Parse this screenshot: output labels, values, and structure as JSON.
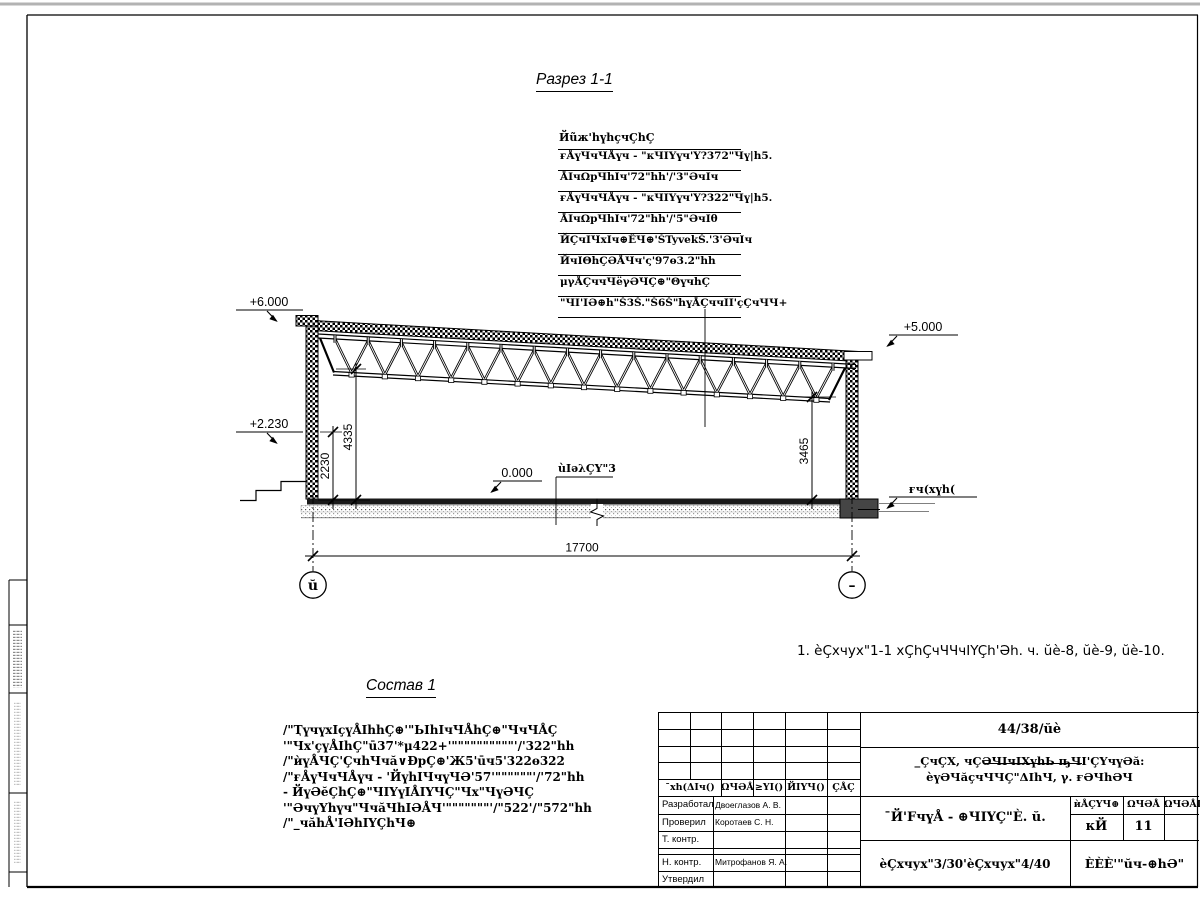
{
  "drawing": {
    "section_title": "Разрез 1-1",
    "roof_callout": {
      "header": "Йũж'hүhçчÇhÇ",
      "rows": [
        "ғÅүЧчЧÅүч - \"кЧIYүч'Y?372\"Чү|h5.",
        "ÅIчΩрЧhIч'72\"hh'/'3\"ӘчIч",
        "ғÅүЧчЧÅүч - \"кЧIYүч'Y?322\"Чү|h5.",
        "ÅIчΩрЧhIч'72\"hh'/'5\"ӘчIθ",
        "ЙÇчIЧхIч⊕ÊЧ⊕'ŠTyvekŠ.'3'ӘчIч",
        "ЙчIΘhÇӘÅЧч'ς'97ө3.2\"hh",
        "μγÅÇччЧёγӘЧÇ⊕\"ΘүчhÇ",
        "\"ЧI'IӘ⊕h\"Š3Š.\"Š6Š\"hүÅÇччII'çÇчЧЧ+"
      ]
    },
    "elevations": {
      "left_top": "+6.000",
      "left_mid": "+2.230",
      "right_top": "+5.000",
      "floor": "0.000",
      "ground_right": "ғч(хүh("
    },
    "labels": {
      "floor_leader": "ùIәλÇY\"3"
    },
    "dimensions": {
      "left_inner": "2230",
      "left_outer": "4335",
      "right_side": "3465",
      "span": "17700"
    },
    "axes": {
      "left": "ŭ",
      "right": "–"
    },
    "note": "1. èÇхчух\"1-1 хÇhÇчЧЧчIYÇh'Әh. ч. ŭè-8, ŭè-9, ŭè-10."
  },
  "composition": {
    "title": "Состав 1",
    "lines": [
      "/\"ҬүчүхIçүÅIhhÇ⊕'\"ЬIhIчЧÅhÇ⊕\"ЧчЧÅÇ",
      "'\"Чх'çүÅIhÇ\"ū37'*μ422+'\"\"\"\"\"\"\"\"\"\"'/'322\"hh",
      "/\"ѝүÅЧÇ'ÇчhЧчă∨ĐрÇ⊕'Ж5'ūч5'322ө322",
      "/\"ғÅүЧчЧÅүч - 'ЙүhIЧчүЧӘ'57'\"\"\"\"\"\"'/'72\"hh",
      "- ЙүӘĕÇhÇ⊕\"ЧIYүIÅIYЧÇ\"Чх\"ЧүӘЧÇ",
      "'\"ӘчүYhүч\"ЧчăЧhIӘÅЧ'\"\"\"\"\"\"\"'/\"522'/\"572\"hh",
      "/\"_чăhÅ'IӘhIYÇhЧ⊕"
    ]
  },
  "title_block": {
    "project_code": "44/38/ŭè",
    "project_name_line1": "_ÇчÇХ, чÇӘЧIчIХүhЬ ҧЧI'ÇYчүӘă:",
    "project_name_line2": "èүӘЧăçчЧЧÇ\"ΔIhЧ, γ. ғӘЧhӘЧ",
    "header_cells": [
      "¯хh(ΔIч()",
      "ΩЧӘÅ",
      "≥YI()",
      "ЙIYЧ()",
      "ÇÅÇ"
    ],
    "rows": [
      {
        "role": "Разработал",
        "name": "Двоеглазов А. В."
      },
      {
        "role": "Проверил",
        "name": "Коротаев С. Н."
      },
      {
        "role": "Т. контр.",
        "name": ""
      },
      {
        "role": "Н. контр.",
        "name": "Митрофанов Я. А."
      },
      {
        "role": "Утвердил",
        "name": ""
      }
    ],
    "sheet_title": "¯Й'FчүÅ - ⊕ЧIYÇ\"È. ŭ.",
    "sheet_subtitle": "èÇхчух\"3/30'èÇхчух\"4/40",
    "stage_table": {
      "headers": [
        "ѝÅÇYЧ⊕",
        "ΩЧӘÅ",
        "ΩЧӘÅI"
      ],
      "stage": "кЙ",
      "sheet": "11",
      "total": ""
    },
    "organization": "ÈÈÈ'\"ŭч-⊕hӘ\""
  }
}
